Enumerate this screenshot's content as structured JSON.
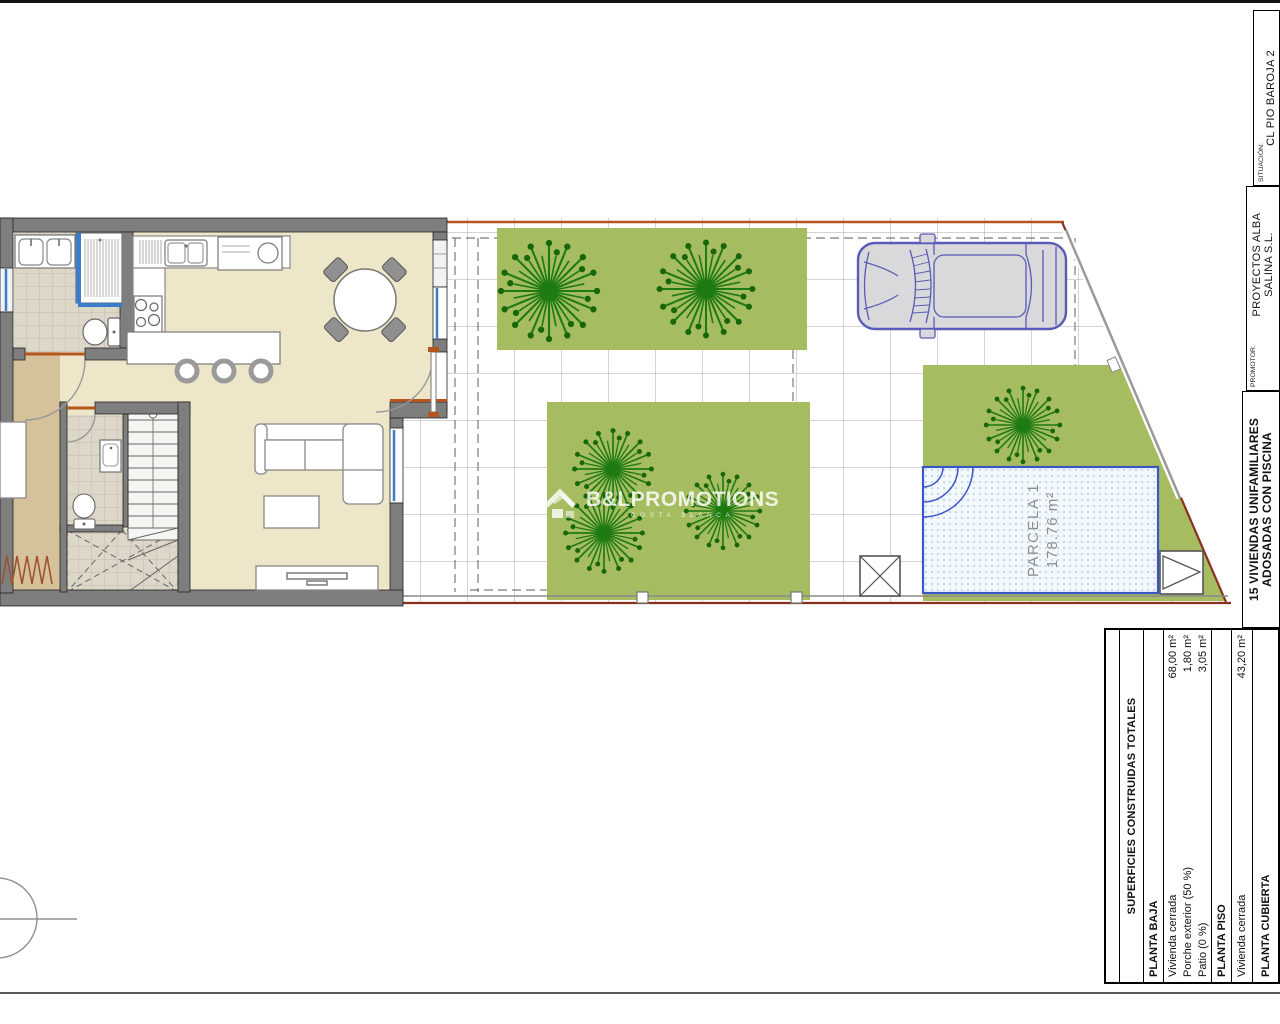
{
  "title_block": {
    "situacion_label": "SITUACIÓN:",
    "situacion_value": "CL PIO BAROJA 2",
    "promotor_label": "PROMOTOR:",
    "promotor_name_line1": "PROYECTOS ALBA",
    "promotor_name_line2": "SALINA S.L.",
    "project_line1": "15 VIVIENDAS UNIFAMILIARES",
    "project_line2": "ADOSADAS CON PISCINA"
  },
  "site": {
    "parcel_label": "PARCELA 1",
    "parcel_area": "178.76 m²"
  },
  "watermark": {
    "brand": "B&LPROMOTIONS",
    "tagline": "COSTA BLANCA"
  },
  "areas_table": {
    "header": "SUPERFICIES CONSTRUIDAS TOTALES",
    "rows": [
      {
        "type": "section",
        "label": "PLANTA BAJA",
        "value": ""
      },
      {
        "type": "item",
        "label": "Vivienda cerrada",
        "value": "68,00 m²"
      },
      {
        "type": "item",
        "label": "Porche exterior (50 %)",
        "value": "1,80 m²"
      },
      {
        "type": "item",
        "label": "Patio (0 %)",
        "value": "3,05 m²"
      },
      {
        "type": "section",
        "label": "PLANTA PISO",
        "value": ""
      },
      {
        "type": "item",
        "label": "Vivienda cerrada",
        "value": "43,20 m²"
      },
      {
        "type": "section",
        "label": "PLANTA CUBIERTA",
        "value": ""
      }
    ]
  },
  "colors": {
    "lawn": "#a5bc61",
    "tree": "#1e7a12",
    "boundary_red": "#8a3020",
    "boundary_orange": "#b4551e",
    "pool_border": "#3c55c8",
    "glazing_blue": "#3b7dc8",
    "wall_gray": "#7e7e7e",
    "floor_beige": "#eee6c9",
    "floor_tan": "#d6c29a",
    "car_blue": "#5a5ab8"
  }
}
